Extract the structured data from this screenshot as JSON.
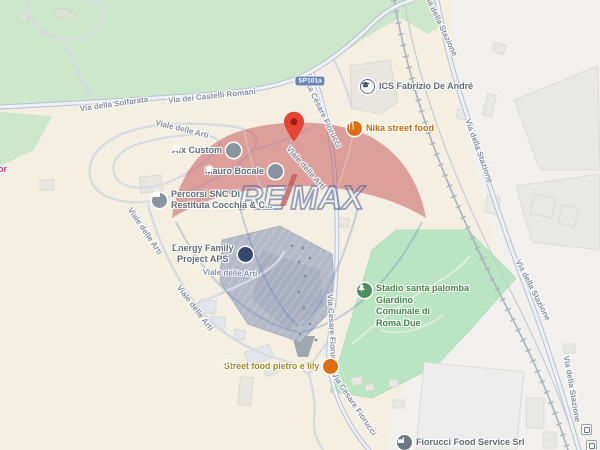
{
  "map_title": "Map of Santa Palomba area with RE/MAX watermark",
  "watermark": {
    "re": "RE",
    "slash": "/",
    "max": "MAX"
  },
  "road_badge": {
    "text": "SP101a"
  },
  "road_labels": [
    {
      "text": "Via della Solfarata"
    },
    {
      "text": "Via dei Castelli Romani"
    },
    {
      "text": "Via della Stazione"
    },
    {
      "text": "Via della Stazione"
    },
    {
      "text": "Via della Stazione"
    },
    {
      "text": "Via della Stazione"
    },
    {
      "text": "Via Cesare Fiorucci"
    },
    {
      "text": "Via Cesare Fiorucci"
    },
    {
      "text": "Via Cesare Fiorucci"
    },
    {
      "text": "Viale delle Arti"
    },
    {
      "text": "Viale delle Arti"
    },
    {
      "text": "Viale delle Arti"
    },
    {
      "text": "Viale delle  Arti"
    },
    {
      "text": "Viale delle Arti"
    }
  ],
  "pois": [
    {
      "name": "ICS Fabrizio De André",
      "icon": "school-icon",
      "lines": [
        "ICS Fabrizio De André"
      ]
    },
    {
      "name": "Nika street food",
      "icon": "restaurant-icon",
      "lines": [
        "Nika street food"
      ]
    },
    {
      "name": "Alx Custom",
      "icon": "business-icon",
      "lines": [
        "Alx Custom"
      ]
    },
    {
      "name": "Mauro Bocale",
      "icon": "business-icon",
      "lines": [
        "Mauro Bocale"
      ]
    },
    {
      "name": "Percorsi SNC Di Restituta Cocchia & C...",
      "icon": "business-icon",
      "lines": [
        "Percorsi SNC Di",
        "Restituta Cocchia & C..."
      ]
    },
    {
      "name": "Energy Family Project APS",
      "icon": "community-icon",
      "lines": [
        "Energy Family",
        "Project APS"
      ]
    },
    {
      "name": "Stadio santa palomba Giardino Comunale di Roma Due",
      "icon": "park-icon",
      "lines": [
        "Stadio santa palomba",
        "Giardino",
        "Comunale di",
        "Roma Due"
      ]
    },
    {
      "name": "Street food pietro e lily",
      "icon": "restaurant-icon",
      "lines": [
        "Street food pietro e lily"
      ]
    },
    {
      "name": "Fiorucci Food Service Srl",
      "icon": "factory-icon",
      "lines": [
        "Fiorucci Food Service Srl"
      ]
    },
    {
      "name": "partial shopping label",
      "icon": "none",
      "lines": [
        "or"
      ]
    }
  ],
  "marker": {
    "name": "red location pin"
  },
  "transit_icons": [
    {
      "name": "train-station-icon"
    },
    {
      "name": "train-station-icon"
    }
  ],
  "colors": {
    "land": "#f4efe1",
    "park_large": "#cde7ca",
    "park_stadio": "#b9e5c2",
    "industrial": "#f1f0ec",
    "road_casing": "#b7c1d1",
    "road_fill": "#eef1f6",
    "minor_road": "#d6dae3",
    "railway": "#aab3bf",
    "building": "#e8e6df",
    "building_dark": "#b4bac8",
    "pin_red": "#ea4335",
    "poi_gray": "#5f6c7b",
    "poi_orange": "#c96a0c",
    "poi_amber": "#a8871f",
    "poi_green": "#3f8843",
    "poi_pink": "#c13d8c",
    "badge_blue": "#6787b7",
    "road_label": "#868da0"
  }
}
